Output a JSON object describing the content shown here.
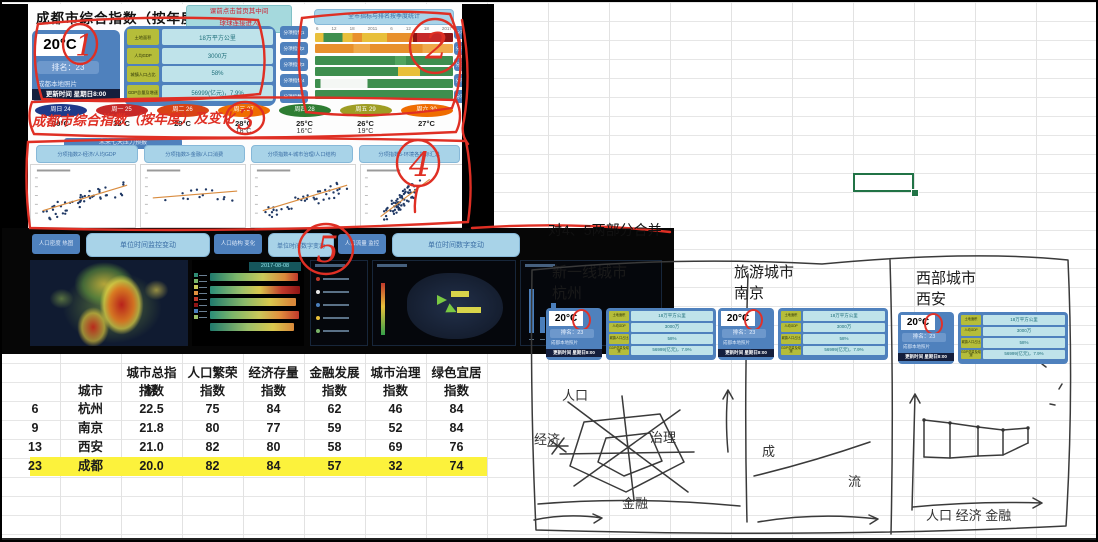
{
  "dashboard_top": {
    "title": "成都市综合指数（按年度排名）",
    "note_line1": "课前点击首页其中间",
    "note_line2": "球球连接进入",
    "weather_card": {
      "temp": "20°C",
      "rank": "排名：23",
      "photo": "成都本地照片",
      "update": "更新时间 星期日8:00"
    },
    "stats": [
      {
        "label": "土地面积",
        "value": "18万平方公里"
      },
      {
        "label": "人均GDP",
        "value": "3000万"
      },
      {
        "label": "城镇人口占比",
        "value": "58%"
      },
      {
        "label": "GDP总量及增速",
        "value": "56999(亿元)，7.9%"
      }
    ],
    "side_buttons": [
      "分项指数1",
      "分项指数2",
      "分项指数3",
      "分项指数4",
      "分项指数5"
    ],
    "horizon_title": "全市指标与排名按季度统计",
    "horizon_ticks": [
      "6",
      "12",
      "18",
      "2011",
      "6",
      "12",
      "18",
      "2017"
    ],
    "week": [
      {
        "day": "周日 24",
        "hi": "30°C",
        "lo": "",
        "color": "#1e3a8a"
      },
      {
        "day": "周一 25",
        "hi": "32°C",
        "lo": "",
        "color": "#c62828"
      },
      {
        "day": "周二 26",
        "hi": "29°C",
        "lo": "",
        "color": "#d84315"
      },
      {
        "day": "周三 27",
        "hi": "28°C",
        "lo": "18°C",
        "color": "#ef6c00"
      },
      {
        "day": "周四 28",
        "hi": "25°C",
        "lo": "16°C",
        "color": "#2e7d32"
      },
      {
        "day": "周五 29",
        "hi": "26°C",
        "lo": "19°C",
        "color": "#9e9d24"
      },
      {
        "day": "周六 30",
        "hi": "27°C",
        "lo": "",
        "color": "#ef6c00"
      }
    ],
    "pressure_tab": "未来七天压力预报",
    "scatter_buttons": [
      "分项指数2-经济/人均GDP",
      "分项指数3-金融/人口消费",
      "分项指数4-城市治理/人口结构",
      "分项指数5-环境各指标汇总"
    ]
  },
  "dashboard_bottom": {
    "chips": [
      "人口密度 热图",
      "人口结构 变化",
      "人口流量 监控"
    ],
    "buttons": [
      "单位时间监控变动",
      "单位时间数字变动",
      "单位时间数字变动"
    ],
    "date_chip": "2017-08-08"
  },
  "annotations": {
    "marks": [
      "1",
      "2",
      "3",
      "4",
      "5"
    ],
    "red_text": "成都市综合指数（按年度）及变化"
  },
  "table": {
    "headers": [
      {
        "l1": "",
        "l2": ""
      },
      {
        "l1": "",
        "l2": "城市"
      },
      {
        "l1": "城市总指标",
        "l2": "指数"
      },
      {
        "l1": "人口繁荣",
        "l2": "指数"
      },
      {
        "l1": "经济存量",
        "l2": "指数"
      },
      {
        "l1": "金融发展",
        "l2": "指数"
      },
      {
        "l1": "城市治理",
        "l2": "指数"
      },
      {
        "l1": "绿色宜居",
        "l2": "指数"
      }
    ],
    "rows": [
      {
        "rank": "6",
        "city": "杭州",
        "values": [
          "22.5",
          "75",
          "84",
          "62",
          "46",
          "84"
        ],
        "highlight": false
      },
      {
        "rank": "9",
        "city": "南京",
        "values": [
          "21.8",
          "80",
          "77",
          "59",
          "52",
          "84"
        ],
        "highlight": false
      },
      {
        "rank": "13",
        "city": "西安",
        "values": [
          "21.0",
          "82",
          "80",
          "58",
          "69",
          "76"
        ],
        "highlight": false
      },
      {
        "rank": "23",
        "city": "成都",
        "values": [
          "20.0",
          "82",
          "84",
          "57",
          "32",
          "74"
        ],
        "highlight": true
      }
    ],
    "highlight_color": "#fcf23c"
  },
  "sketch": {
    "merge_note": "对4、5两部分合并",
    "sections": [
      {
        "line1": "新一线城市",
        "line2": "杭州"
      },
      {
        "line1": "旅游城市",
        "line2": "南京"
      },
      {
        "line1": "西部城市",
        "line2": "西安"
      }
    ],
    "radar_labels": [
      "人口",
      "经济",
      "治理",
      "金融"
    ],
    "sec2_labels": [
      "成",
      "流"
    ],
    "sec3_axis_label": "人口 经济 金融"
  }
}
